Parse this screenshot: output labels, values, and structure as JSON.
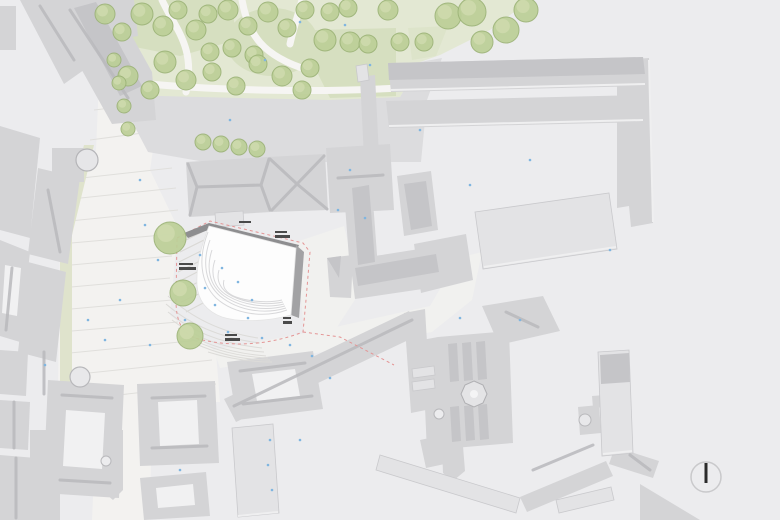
{
  "meta": {
    "kind": "architectural-site-plan",
    "description": "Top-down urban site plan: historic gray building fabric, park with trees (top), light pedestrian plaza (left), white curved proposed building in center with red dashed site boundary, north indicator bottom right.",
    "no_readable_text": true
  },
  "palette": {
    "background": "#ececee",
    "plaza": "#f3f2f0",
    "paving_line": "#e0dfdc",
    "park_ground": "#e3e8d3",
    "lawn": "#d6dfc0",
    "path_white": "#f6f5f3",
    "green_strip": "#dfe3cc",
    "gray_paved": "#dcdcde",
    "building_base": "#d4d4d6",
    "building_light": "#e3e3e5",
    "facet_dark": "#c5c5c8",
    "courtyard_white": "#f1f1f2",
    "ridge_line": "#b9b9bc",
    "edge_light": "#efeff0",
    "proposed_white": "#fdfdfd",
    "proposed_dark_band": "#8e8e90",
    "proposed_side_band": "#a2a2a4",
    "curve_line": "#d8d8da",
    "site_boundary_red": "#e49595",
    "tree_fill": "#bccf97",
    "tree_edge": "#9cb377",
    "tree_highlight": "#cfdaae",
    "dot_blue": "#7fb5e0",
    "label_mark": "#4a4a4a",
    "north_ring": "#c9c9cb",
    "north_needle": "#2b2b2b"
  },
  "north_arrow": {
    "cx": 706,
    "cy": 477,
    "r": 15,
    "needle_len": 20,
    "needle_w": 3
  },
  "trees": {
    "park": [
      [
        105,
        14,
        10
      ],
      [
        122,
        32,
        9
      ],
      [
        142,
        14,
        11
      ],
      [
        163,
        26,
        10
      ],
      [
        178,
        10,
        9
      ],
      [
        196,
        30,
        10
      ],
      [
        208,
        14,
        9
      ],
      [
        228,
        10,
        10
      ],
      [
        248,
        26,
        9
      ],
      [
        268,
        12,
        10
      ],
      [
        287,
        28,
        9
      ],
      [
        305,
        10,
        9
      ],
      [
        330,
        12,
        9
      ],
      [
        348,
        8,
        9
      ],
      [
        210,
        52,
        9
      ],
      [
        232,
        48,
        9
      ],
      [
        254,
        55,
        9
      ],
      [
        165,
        62,
        11
      ],
      [
        186,
        80,
        10
      ],
      [
        212,
        72,
        9
      ],
      [
        236,
        86,
        9
      ],
      [
        258,
        64,
        9
      ],
      [
        282,
        76,
        10
      ],
      [
        302,
        90,
        9
      ],
      [
        150,
        90,
        9
      ],
      [
        128,
        76,
        10
      ],
      [
        310,
        68,
        9
      ],
      [
        325,
        40,
        11
      ],
      [
        350,
        42,
        10
      ],
      [
        368,
        44,
        9
      ],
      [
        388,
        10,
        10
      ],
      [
        400,
        42,
        9
      ],
      [
        424,
        42,
        9
      ],
      [
        448,
        16,
        13
      ],
      [
        472,
        12,
        14
      ],
      [
        482,
        42,
        11
      ],
      [
        506,
        30,
        13
      ],
      [
        526,
        10,
        12
      ]
    ],
    "street_column": [
      [
        114,
        60,
        7
      ],
      [
        119,
        83,
        7
      ],
      [
        124,
        106,
        7
      ],
      [
        128,
        129,
        7
      ]
    ],
    "avenue_row": [
      [
        203,
        142,
        8
      ],
      [
        221,
        144,
        8
      ],
      [
        239,
        147,
        8
      ],
      [
        257,
        149,
        8
      ]
    ],
    "plaza": [
      [
        170,
        238,
        16
      ],
      [
        183,
        293,
        13
      ],
      [
        190,
        336,
        13
      ]
    ]
  },
  "dots": {
    "color": "#7fb5e0",
    "points": [
      [
        140,
        180
      ],
      [
        230,
        120
      ],
      [
        265,
        60
      ],
      [
        300,
        22
      ],
      [
        345,
        25
      ],
      [
        370,
        65
      ],
      [
        145,
        225
      ],
      [
        158,
        260
      ],
      [
        200,
        255
      ],
      [
        222,
        268
      ],
      [
        238,
        282
      ],
      [
        252,
        300
      ],
      [
        215,
        305
      ],
      [
        185,
        320
      ],
      [
        228,
        332
      ],
      [
        262,
        338
      ],
      [
        290,
        345
      ],
      [
        312,
        356
      ],
      [
        330,
        378
      ],
      [
        120,
        300
      ],
      [
        105,
        340
      ],
      [
        88,
        320
      ],
      [
        270,
        440
      ],
      [
        300,
        440
      ],
      [
        268,
        465
      ],
      [
        272,
        490
      ],
      [
        180,
        470
      ],
      [
        45,
        365
      ],
      [
        150,
        345
      ],
      [
        365,
        218
      ],
      [
        338,
        210
      ],
      [
        470,
        185
      ],
      [
        420,
        130
      ],
      [
        530,
        160
      ],
      [
        610,
        250
      ],
      [
        520,
        320
      ],
      [
        460,
        318
      ],
      [
        350,
        170
      ],
      [
        248,
        318
      ],
      [
        205,
        288
      ]
    ]
  },
  "micro_labels": {
    "note": "tiny illegible annotation marks on the plan",
    "marks": [
      {
        "x": 179,
        "y": 263,
        "w": 14,
        "h": 2
      },
      {
        "x": 179,
        "y": 267,
        "w": 17,
        "h": 3
      },
      {
        "x": 275,
        "y": 231,
        "w": 12,
        "h": 2
      },
      {
        "x": 275,
        "y": 235,
        "w": 15,
        "h": 3
      },
      {
        "x": 239,
        "y": 221,
        "w": 12,
        "h": 2
      },
      {
        "x": 225,
        "y": 334,
        "w": 12,
        "h": 2
      },
      {
        "x": 225,
        "y": 338,
        "w": 15,
        "h": 3
      },
      {
        "x": 283,
        "y": 317,
        "w": 8,
        "h": 2
      },
      {
        "x": 283,
        "y": 321,
        "w": 9,
        "h": 3
      }
    ]
  }
}
